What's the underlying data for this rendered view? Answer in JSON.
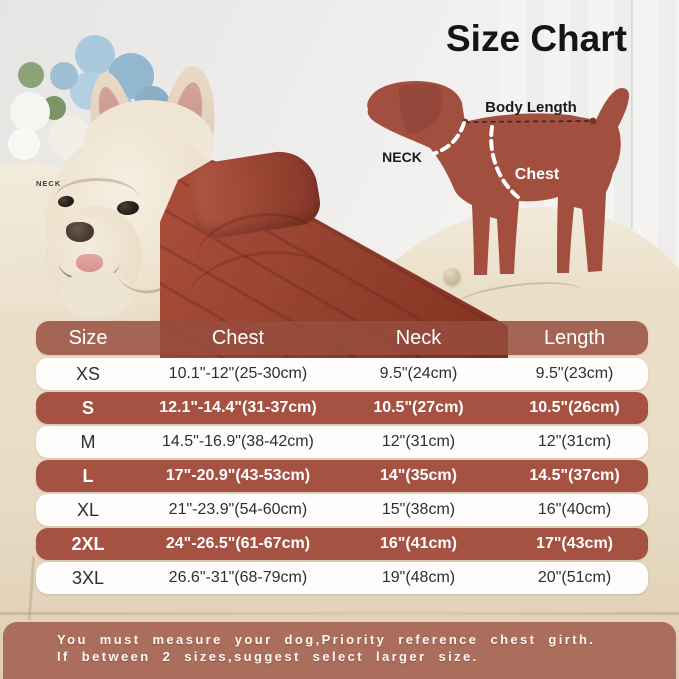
{
  "title": "Size Chart",
  "diagram": {
    "body_length_label": "Body Length",
    "neck_label": "NECK",
    "chest_label": "Chest"
  },
  "photo_label": {
    "neck_tag": "NECK"
  },
  "table": {
    "columns": [
      "Size",
      "Chest",
      "Neck",
      "Length"
    ],
    "rows": [
      {
        "size": "XS",
        "chest": "10.1\"-12\"(25-30cm)",
        "neck": "9.5\"(24cm)",
        "length": "9.5\"(23cm)"
      },
      {
        "size": "S",
        "chest": "12.1\"-14.4\"(31-37cm)",
        "neck": "10.5\"(27cm)",
        "length": "10.5\"(26cm)"
      },
      {
        "size": "M",
        "chest": "14.5\"-16.9\"(38-42cm)",
        "neck": "12\"(31cm)",
        "length": "12\"(31cm)"
      },
      {
        "size": "L",
        "chest": "17\"-20.9\"(43-53cm)",
        "neck": "14\"(35cm)",
        "length": "14.5\"(37cm)"
      },
      {
        "size": "XL",
        "chest": "21\"-23.9\"(54-60cm)",
        "neck": "15\"(38cm)",
        "length": "16\"(40cm)"
      },
      {
        "size": "2XL",
        "chest": "24\"-26.5\"(61-67cm)",
        "neck": "16\"(41cm)",
        "length": "17\"(43cm)"
      },
      {
        "size": "3XL",
        "chest": "26.6\"-31\"(68-79cm)",
        "neck": "19\"(48cm)",
        "length": "20\"(51cm)"
      }
    ]
  },
  "note": {
    "line1": "You must measure your dog,Priority reference chest girth.",
    "line2": "If between 2 sizes,suggest select larger size."
  },
  "colors": {
    "brick_row": "#a65243",
    "header_bg": "rgba(150,78,62,0.84)",
    "note_bg": "rgba(169,106,88,0.96)",
    "diagram_dog": "#a24f3f",
    "jacket": "#9c4433",
    "couch": "#e9ddc9",
    "flower_blue": "#a3c6da",
    "title_text": "#151515",
    "row_text": "#2f2f2f"
  },
  "chart_data": {
    "type": "table",
    "title": "Size Chart",
    "columns": [
      "Size",
      "Chest",
      "Neck",
      "Length"
    ],
    "rows": [
      [
        "XS",
        "10.1\"-12\"(25-30cm)",
        "9.5\"(24cm)",
        "9.5\"(23cm)"
      ],
      [
        "S",
        "12.1\"-14.4\"(31-37cm)",
        "10.5\"(27cm)",
        "10.5\"(26cm)"
      ],
      [
        "M",
        "14.5\"-16.9\"(38-42cm)",
        "12\"(31cm)",
        "12\"(31cm)"
      ],
      [
        "L",
        "17\"-20.9\"(43-53cm)",
        "14\"(35cm)",
        "14.5\"(37cm)"
      ],
      [
        "XL",
        "21\"-23.9\"(54-60cm)",
        "15\"(38cm)",
        "16\"(40cm)"
      ],
      [
        "2XL",
        "24\"-26.5\"(61-67cm)",
        "16\"(41cm)",
        "17\"(43cm)"
      ],
      [
        "3XL",
        "26.6\"-31\"(68-79cm)",
        "19\"(48cm)",
        "20\"(51cm)"
      ]
    ]
  }
}
